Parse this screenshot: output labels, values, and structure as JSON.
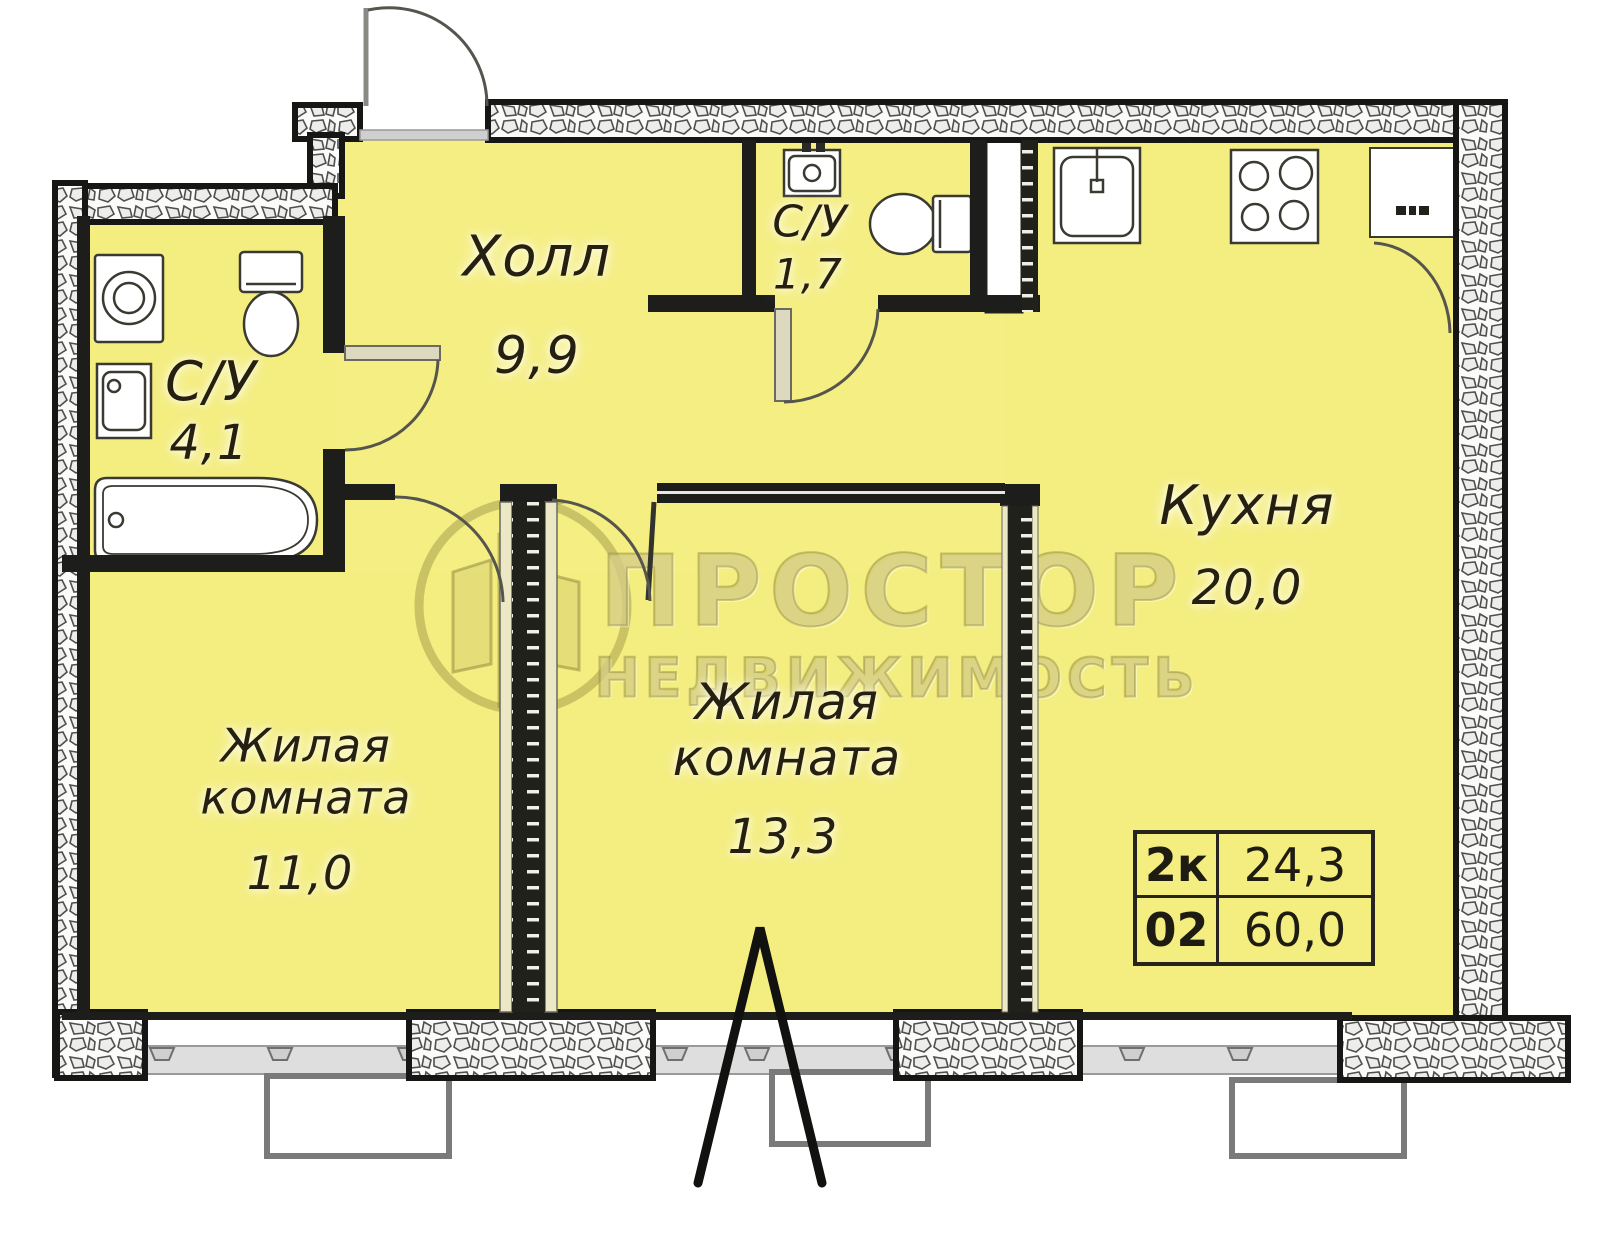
{
  "title": "Floor plan 2-room apartment",
  "rooms": {
    "hall": {
      "name": "Холл",
      "area": "9,9"
    },
    "bath_main": {
      "name": "С/У",
      "area": "4,1"
    },
    "bath_small": {
      "name": "С/У",
      "area": "1,7"
    },
    "kitchen": {
      "name": "Кухня",
      "area": "20,0"
    },
    "living1": {
      "name": "Жилая комната",
      "area": "11,0"
    },
    "living2": {
      "name": "Жилая комната",
      "area": "13,3"
    }
  },
  "info_table": {
    "r1c1": "2к",
    "r1c2": "24,3",
    "r2c1": "02",
    "r2c2": "60,0"
  },
  "watermark": {
    "brand": "ПРОСТОР",
    "tagline": "НЕДВИЖИМОСТЬ"
  },
  "colors": {
    "floor": "#f4ed7f",
    "wall": "#1d1d1b",
    "sill": "#dedede",
    "watermark": "#c4bb64"
  }
}
